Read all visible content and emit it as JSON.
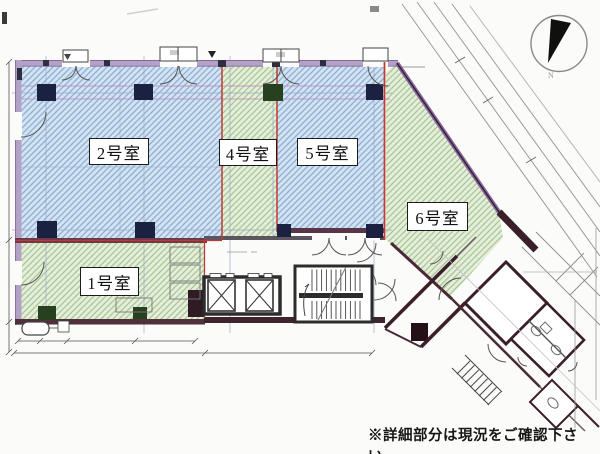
{
  "rooms": [
    {
      "id": "1",
      "label": "1号室",
      "fill": "green-hatch"
    },
    {
      "id": "2",
      "label": "2号室",
      "fill": "blue-hatch"
    },
    {
      "id": "4",
      "label": "4号室",
      "fill": "green-hatch"
    },
    {
      "id": "5",
      "label": "5号室",
      "fill": "blue-hatch"
    },
    {
      "id": "6",
      "label": "6号室",
      "fill": "green-hatch"
    }
  ],
  "compass": {
    "label": "N"
  },
  "note": {
    "text": "※詳細部分は現況をご確認下さい。"
  },
  "colors": {
    "paper": "#fbfbf9",
    "hatch_blue_bg": "#d4e3f1",
    "hatch_blue_line": "#8cb0d4",
    "hatch_green_bg": "#e4eeda",
    "hatch_green_line": "#a8c593",
    "wall_purple": "#b3a2c6",
    "wall_maroon": "#4a2430",
    "boundary_red": "#c03a34",
    "column_navy": "#1b2140"
  }
}
